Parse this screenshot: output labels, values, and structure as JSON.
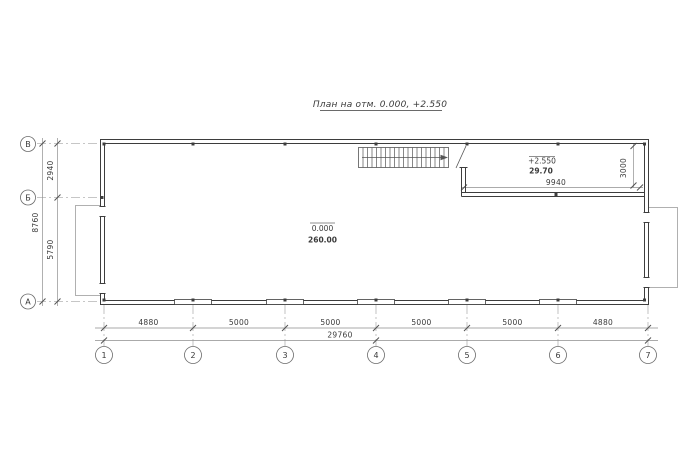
{
  "sheet": {
    "title": "План на отм. 0.000, +2.550"
  },
  "colors": {
    "wall": "#3d3d3d",
    "dimension_line": "#8f8f8f",
    "axis_line": "#b4b4b4",
    "platform_outline": "#b0b0b0",
    "text": "#3a3a3a",
    "background": "#ffffff"
  },
  "axes": {
    "rows": [
      "В",
      "Б",
      "А"
    ],
    "columns": [
      "1",
      "2",
      "3",
      "4",
      "5",
      "6",
      "7"
    ]
  },
  "dimensions": {
    "bottom_segments": [
      "4880",
      "5000",
      "5000",
      "5000",
      "5000",
      "4880"
    ],
    "bottom_total": "29760",
    "left_segments": [
      "2940",
      "5790"
    ],
    "left_total": "8760",
    "mezzanine_width": "9940",
    "mezzanine_depth": "3000"
  },
  "rooms": {
    "main": {
      "elevation": "0.000",
      "area": "260.00"
    },
    "mezzanine": {
      "elevation": "+2.550",
      "area": "29.70"
    }
  }
}
